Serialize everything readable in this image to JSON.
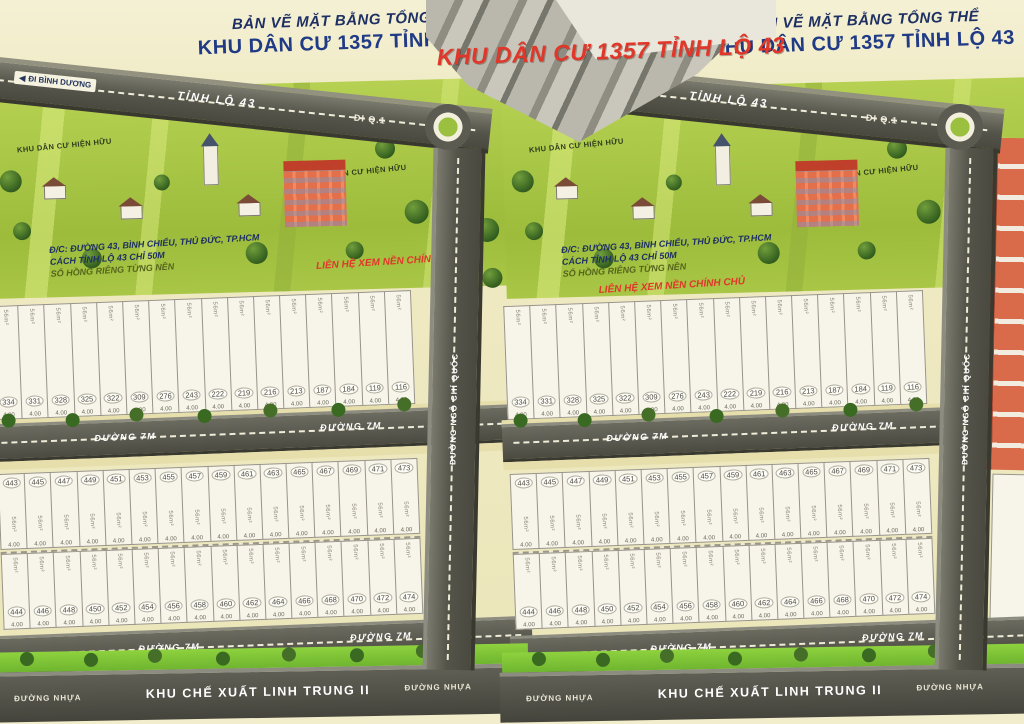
{
  "meta": {
    "description": "Bản vẽ mặt bằng phân lô khu dân cư, hai hình ghép cạnh nhau"
  },
  "colors": {
    "cream": "#efe9c2",
    "green": "#a9c646",
    "green_bright": "#7cc437",
    "road": "#504f46",
    "navy": "#1e2f63",
    "red": "#e0372a",
    "plot": "#f7f5ea",
    "orange_building": "#e4704b"
  },
  "title": {
    "line1": "BẢN VẼ MẶT BẰNG TỔNG THỂ",
    "line2": "KHU DÂN CƯ 1357 TỈNH LỘ 43",
    "overlay": "KHU DÂN CƯ 1357 TỈNH LỘ 43"
  },
  "roads": {
    "arrow_left": "◀",
    "di_binh_duong": "ĐI BÌNH DƯƠNG",
    "tinh_lo_43": "TỈNH LỘ 43",
    "di_q1": "ĐI Q.1",
    "duong_7m": "ĐƯỜNG 7M",
    "duong_nhua": "ĐƯỜNG NHỰA",
    "ngo_chi_quoc": "ĐƯỜNG NGÔ CHÍ QUỐC",
    "kcx": "KHU CHẾ XUẤT LINH TRUNG II"
  },
  "labels": {
    "existing_area": "KHU DÂN CƯ HIỆN HỮU",
    "address_line1": "Đ/C: ĐƯỜNG 43, BÌNH CHIỂU, THỦ ĐỨC, TP.HCM",
    "address_line2": "CÁCH TỈNH LỘ 43 CHỈ 50M",
    "address_line3": "SỔ HỒNG RIÊNG TỪNG NỀN",
    "contact": "LIÊN HỆ XEM NỀN CHÍNH CHỦ"
  },
  "plots": {
    "area": "56m²",
    "dim": "4.00",
    "band1": [
      "334",
      "331",
      "328",
      "325",
      "322",
      "309",
      "276",
      "243",
      "222",
      "219",
      "216",
      "213",
      "187",
      "184",
      "119",
      "116"
    ],
    "band2_top": [
      "443",
      "445",
      "447",
      "449",
      "451",
      "453",
      "455",
      "457",
      "459",
      "461",
      "463",
      "465",
      "467",
      "469",
      "471",
      "473"
    ],
    "band2_bottom": [
      "444",
      "446",
      "448",
      "450",
      "452",
      "454",
      "456",
      "458",
      "460",
      "462",
      "464",
      "466",
      "468",
      "470",
      "472",
      "474"
    ]
  },
  "panels": [
    "left",
    "right"
  ]
}
